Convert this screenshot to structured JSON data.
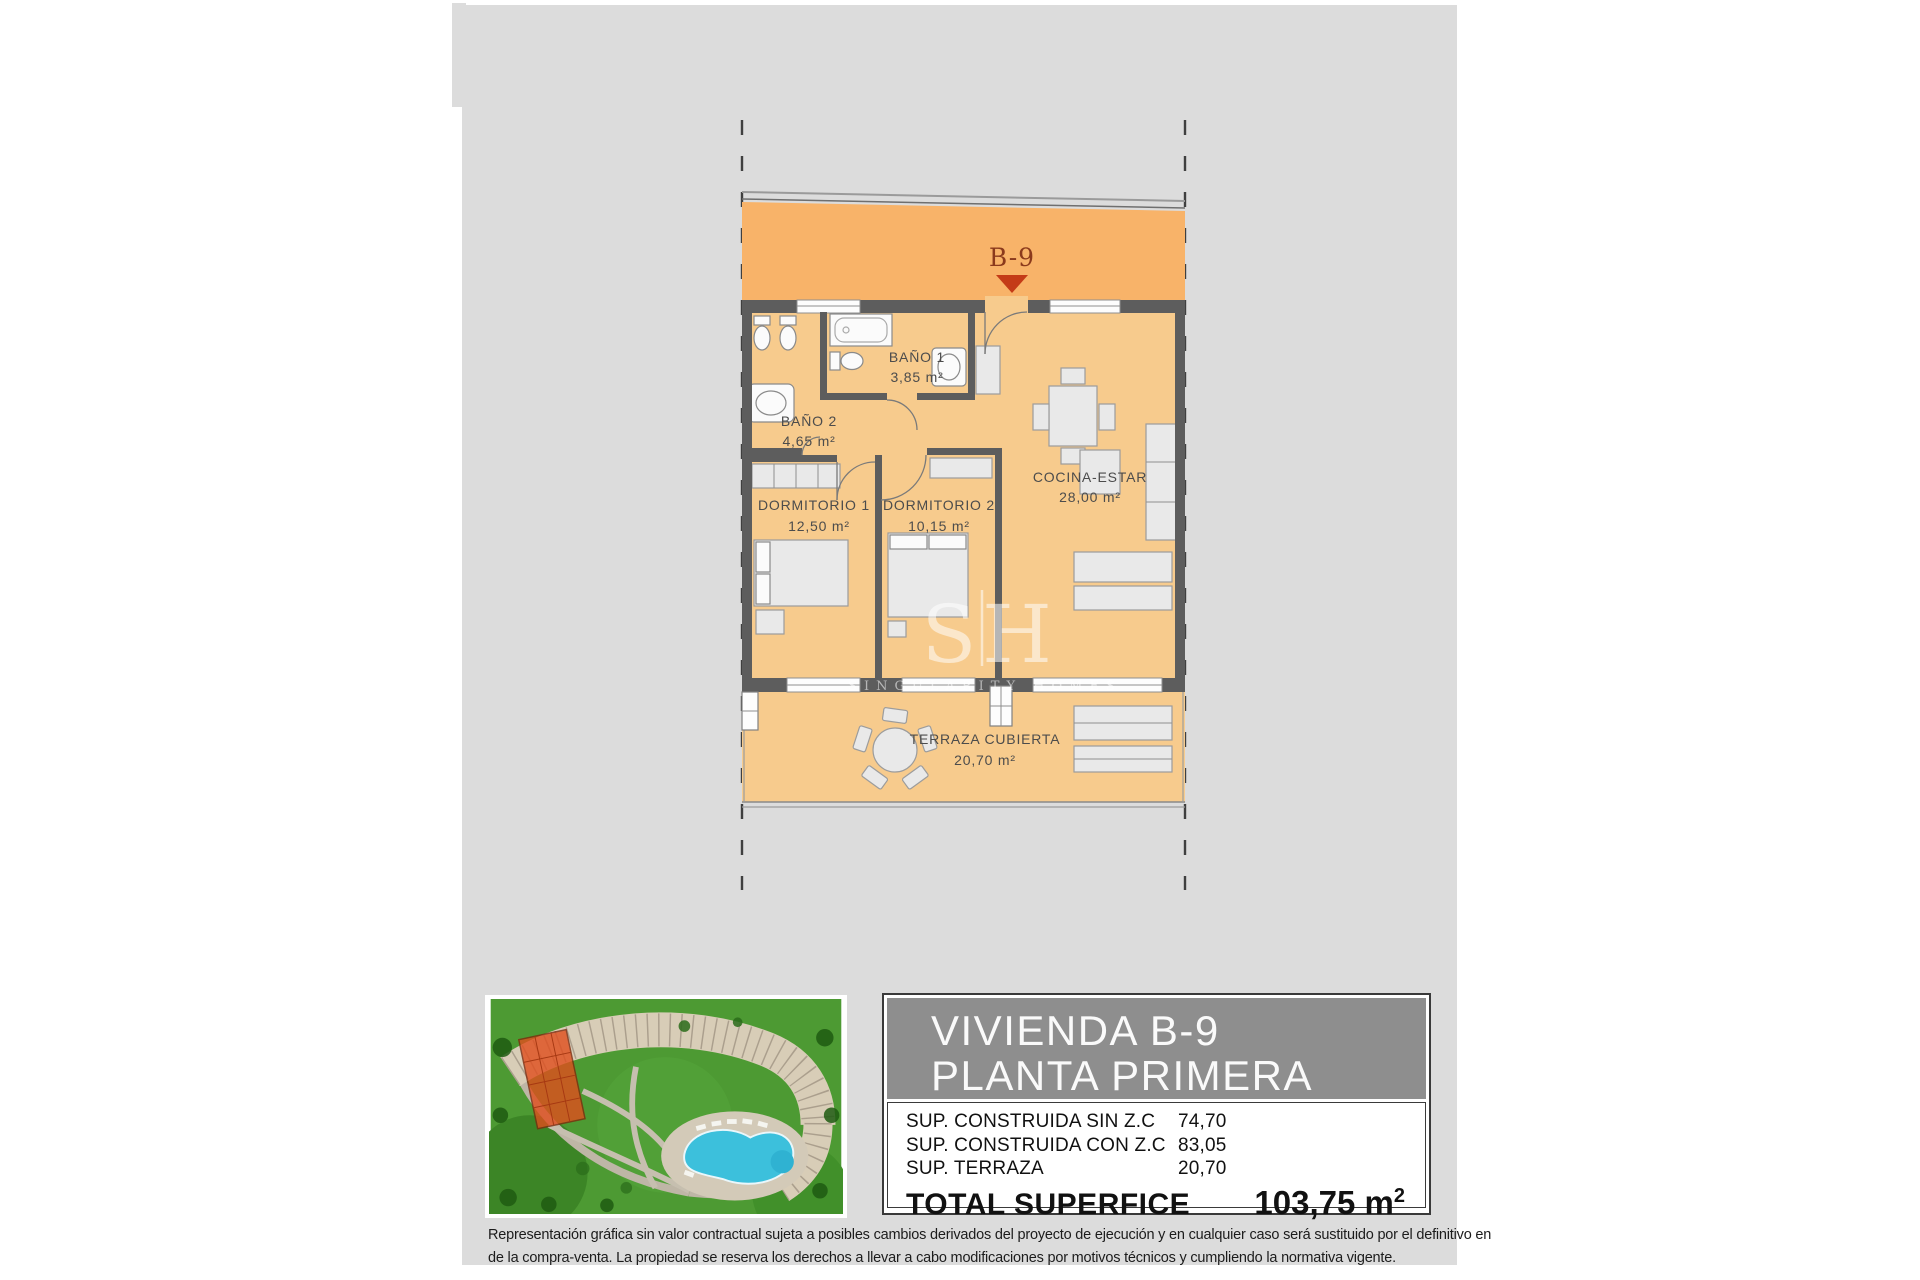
{
  "plan": {
    "unit_label": "B-9",
    "rooms": [
      {
        "name": "BAÑO 1",
        "area": "3,85 m²"
      },
      {
        "name": "BAÑO 2",
        "area": "4,65 m²"
      },
      {
        "name": "DORMITORIO 1",
        "area": "12,50 m²"
      },
      {
        "name": "DORMITORIO 2",
        "area": "10,15 m²"
      },
      {
        "name": "COCINA-ESTAR",
        "area": "28,00 m²"
      },
      {
        "name": "TERRAZA CUBIERTA",
        "area": "20,70 m²"
      }
    ],
    "watermark": {
      "left": "S",
      "right": "H",
      "caption": "SINGULARITY HOMES"
    }
  },
  "info": {
    "title_line1": "VIVIENDA B-9",
    "title_line2": "PLANTA PRIMERA",
    "rows": [
      {
        "label": "SUP. CONSTRUIDA SIN Z.C",
        "value": "74,70"
      },
      {
        "label": "SUP. CONSTRUIDA CON Z.C",
        "value": "83,05"
      },
      {
        "label": "SUP. TERRAZA",
        "value": "20,70"
      }
    ],
    "total_label": "TOTAL SUPERFICE",
    "total_value": "103,75",
    "total_unit_base": " m",
    "total_unit_exp": "2"
  },
  "disclaimer": {
    "line1": "Representación gráfica sin valor contractual sujeta a posibles cambios derivados del proyecto de ejecución y en cualquier caso será sustituido por el definitivo en",
    "line2": "de la compra-venta. La propiedad se reserva los derechos a llevar a cabo modificaciones por motivos técnicos y cumpliendo la normativa vigente."
  },
  "colors": {
    "canvas": "#dcdcdc",
    "corridor_band": "#f8b369",
    "apartment_floor": "#f7cb8d",
    "walls": "#5d5d5d",
    "unit_label": "#8b3a1c",
    "pointer_arrow": "#c43b17",
    "title_block": "#8e8e8e",
    "highlight_building": "#e04e1d",
    "pool": "#3cc0dc",
    "grass": "#4d9a33"
  }
}
